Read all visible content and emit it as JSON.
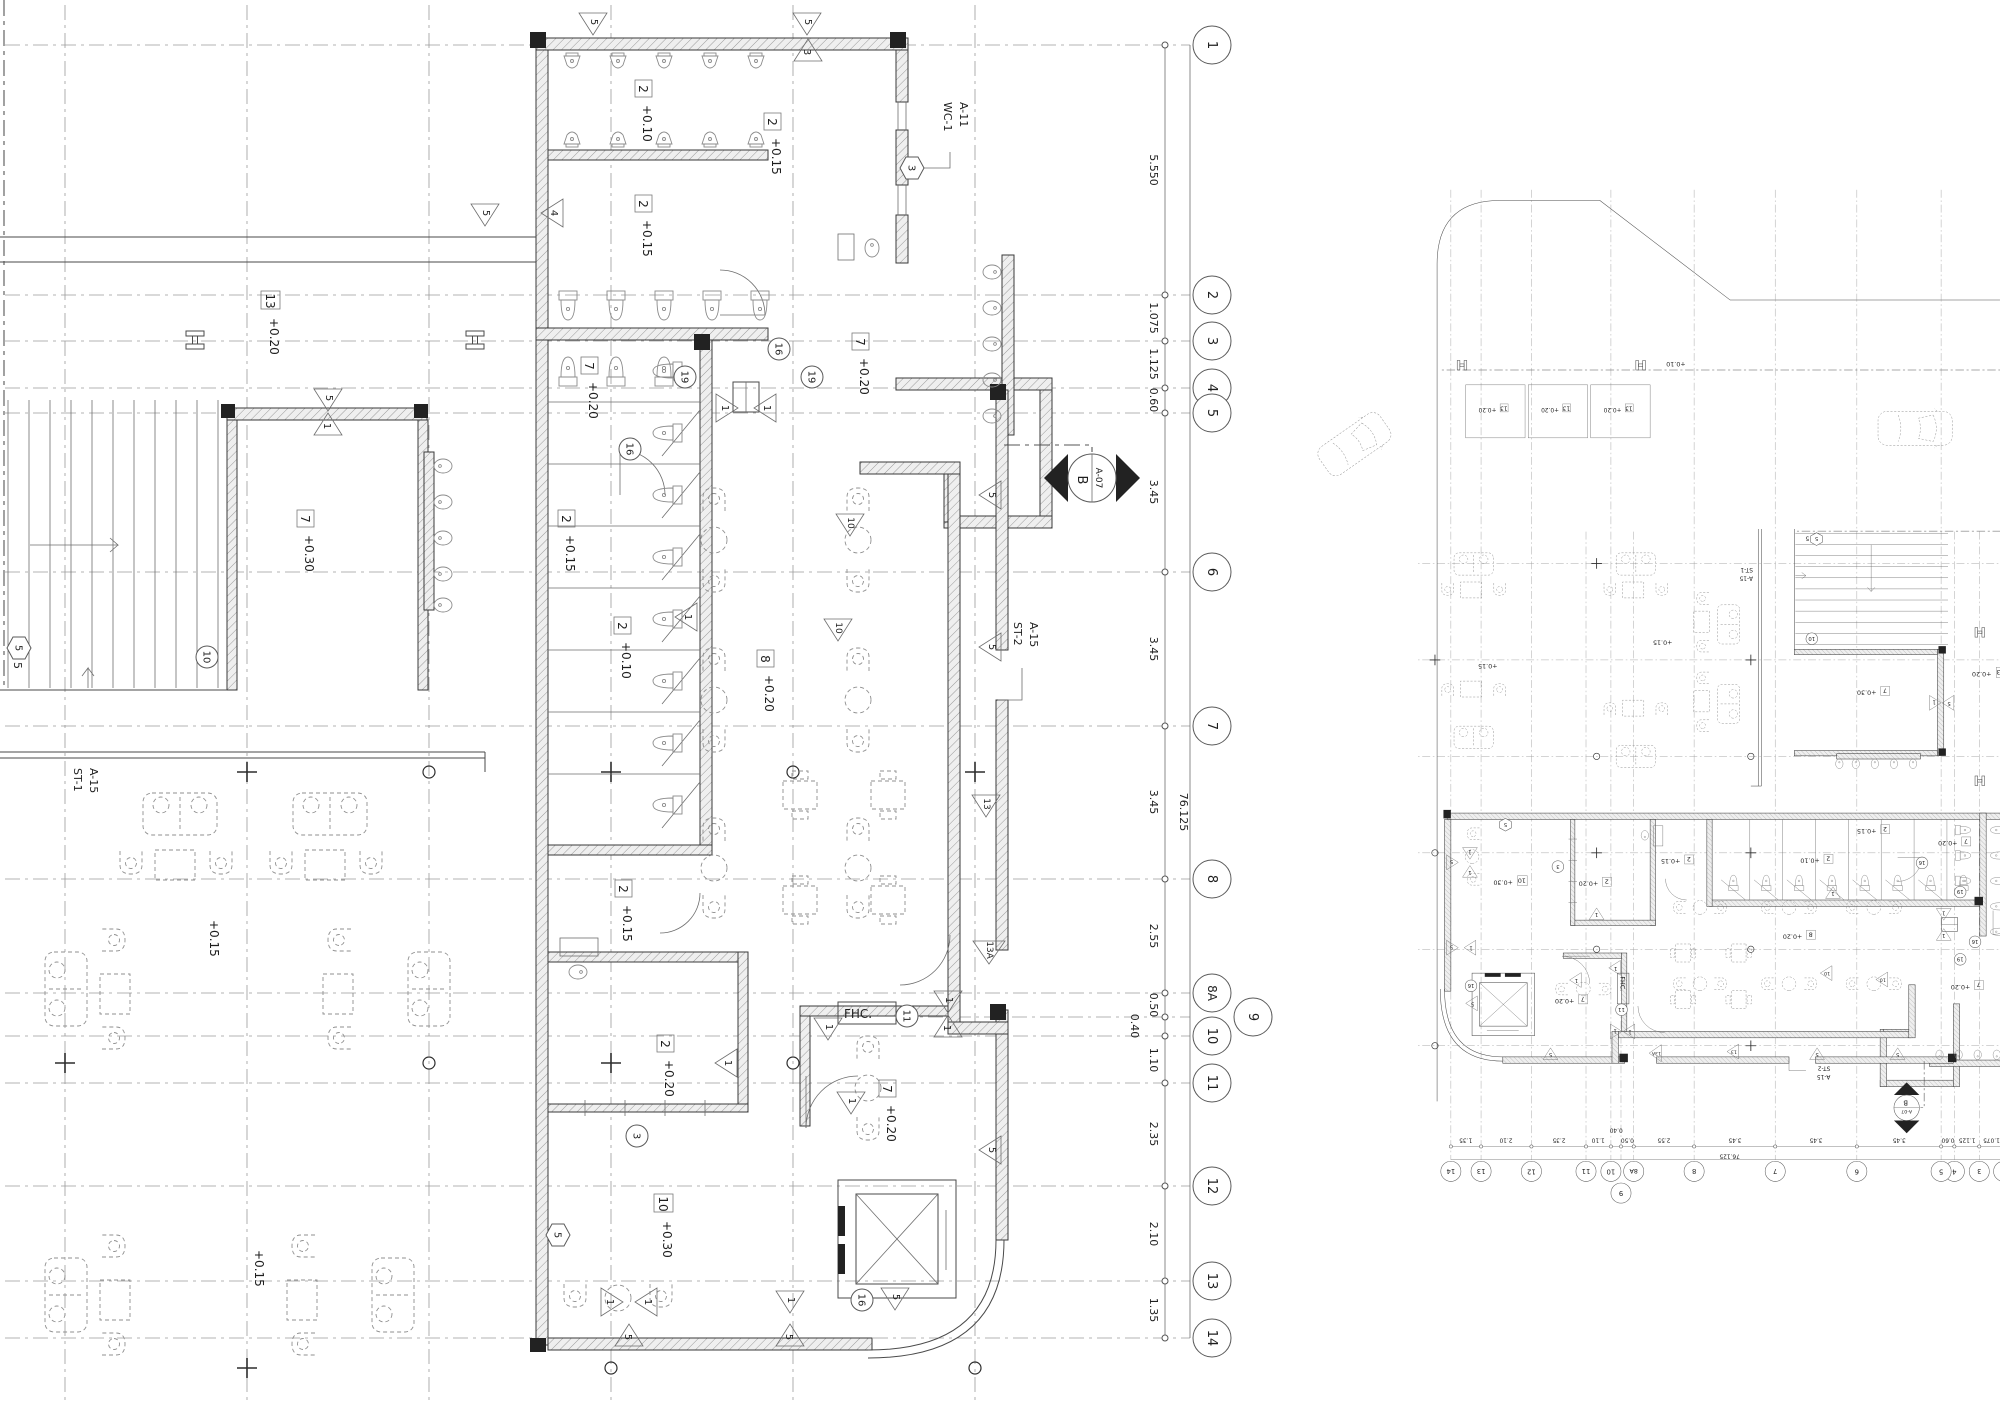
{
  "drawing": {
    "type": "architectural-floor-plan",
    "left_plan": {
      "bubbles": [
        "1",
        "2",
        "3",
        "4",
        "5",
        "6",
        "7",
        "8",
        "8A",
        "9",
        "10",
        "11",
        "12",
        "13",
        "14"
      ],
      "dims": [
        "5.550",
        "1.075",
        "1.125",
        "0.60",
        "3.45",
        "3.45",
        "3.45",
        "2.55",
        "0.50",
        "0.40",
        "1.10",
        "2.35",
        "2.10",
        "1.35"
      ],
      "total_dim": "76.125",
      "rooms": [
        {
          "num": "13",
          "level": "+0.20"
        },
        {
          "num": "7",
          "level": "+0.30"
        },
        {
          "num": "2",
          "level": "+0.10"
        },
        {
          "num": "2",
          "level": "+0.15"
        },
        {
          "num": "2",
          "level": "+0.15"
        },
        {
          "num": "7",
          "level": "+0.20"
        },
        {
          "num": "7",
          "level": "+0.20"
        },
        {
          "num": "2",
          "level": "+0.15"
        },
        {
          "num": "2",
          "level": "+0.10"
        },
        {
          "num": "2",
          "level": "+0.15"
        },
        {
          "num": "8",
          "level": "+0.20"
        },
        {
          "num": "2",
          "level": "+0.20"
        },
        {
          "num": "10",
          "level": "+0.30"
        },
        {
          "num": "7",
          "level": "+0.20"
        }
      ],
      "floor_levels": [
        "+0.15",
        "+0.15"
      ],
      "stair_numbers": [
        "5",
        "10"
      ],
      "callouts": {
        "wc1_line1": "WC-1",
        "wc1_line2": "A-11",
        "st1_line1": "ST-1",
        "st1_line2": "A-15",
        "st2_line1": "ST-2",
        "st2_line2": "A-15"
      },
      "section_marker": {
        "letter": "B",
        "sheet": "A-07"
      },
      "fhc_label": "FHC.",
      "circle_tags": [
        "16",
        "19",
        "16",
        "19",
        "3",
        "11",
        "16",
        "10"
      ],
      "hex_tags": [
        "3",
        "5",
        "5"
      ],
      "tri_tags": [
        "5",
        "5",
        "3",
        "4",
        "5",
        "5",
        "1",
        "1",
        "1",
        "1",
        "10",
        "10",
        "5",
        "5",
        "13",
        "13A",
        "1",
        "1",
        "1",
        "1",
        "1",
        "5",
        "1",
        "1",
        "5",
        "1",
        "5",
        "5"
      ]
    },
    "right_plan": {
      "road_level": "+0.10",
      "parking_labels": [
        {
          "num": "13",
          "level": "+0.20"
        },
        {
          "num": "13",
          "level": "+0.20"
        },
        {
          "num": "13",
          "level": "+0.20"
        }
      ]
    }
  }
}
